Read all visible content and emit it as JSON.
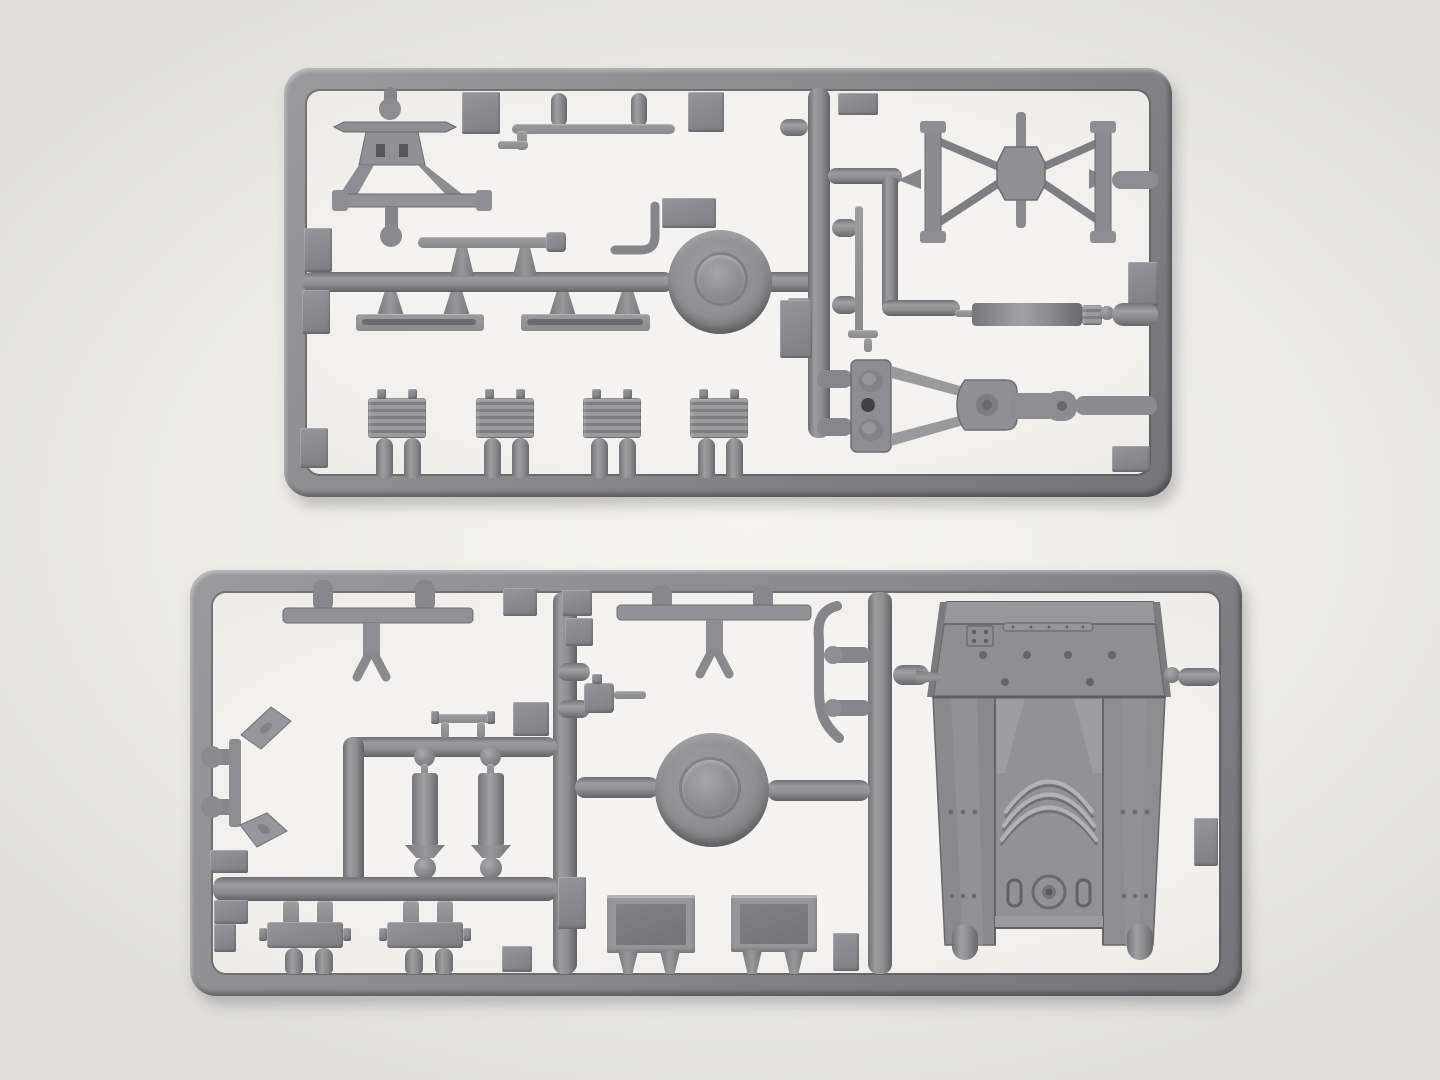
{
  "scene": {
    "type": "photograph",
    "subject": "Two gray injection-molded plastic model-kit sprues (part frames) laid on a bright light-gray surface",
    "text_content": "none",
    "colors": {
      "background": "#e9e8e5",
      "backdrop_glow": "#f6f5f2",
      "sprue_window": "#f4f3f1",
      "plastic_base": "#8b8b8e",
      "plastic_light": "#a2a2a5",
      "plastic_dark": "#646468",
      "detail_dark": "#5a5a5e"
    },
    "sprues": [
      {
        "name": "upper-sprue",
        "shape": "rounded rectangular runner frame",
        "parts": [
          "a-frame-sight-mount",
          "linkage-rod",
          "equipment-rod-with-muzzle",
          "road-wheel",
          "crank-handle",
          "axle-block",
          "flat-rail-left",
          "flat-rail-right",
          "thin-pole-with-foot",
          "spool-butterfly-frame",
          "exhaust-cylinder-assembly",
          "tow-triangle-with-lunette",
          "ammo-box-1",
          "ammo-box-2",
          "ammo-box-3",
          "ammo-box-4"
        ]
      },
      {
        "name": "lower-sprue",
        "shape": "rounded rectangular runner frame with internal runners",
        "parts": [
          "t-bar-with-fork-left",
          "t-bar-with-fork-right",
          "s-curved-rod",
          "mg-mount",
          "road-wheel",
          "grab-handle",
          "recoil-cylinder-1",
          "recoil-cylinder-2",
          "fender-bracket",
          "track-link-1",
          "track-link-2",
          "stowage-box-1",
          "stowage-box-2",
          "hull-superstructure-with-rivets-and-hatch-arcs"
        ]
      }
    ]
  }
}
